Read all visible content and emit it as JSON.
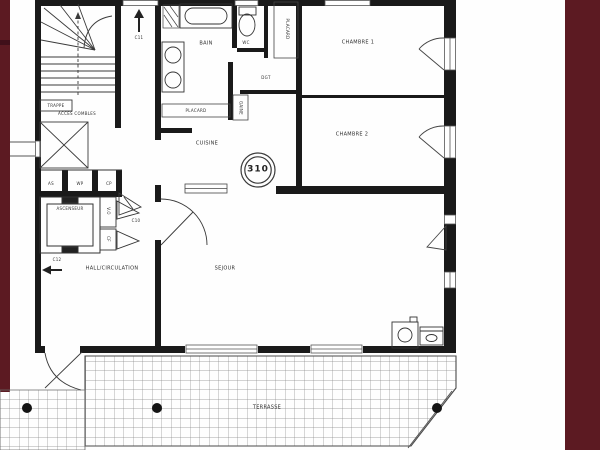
{
  "floorplan": {
    "unit_number": "310",
    "rooms": {
      "sejour": "SEJOUR",
      "cuisine": "CUISINE",
      "bain": "BAIN",
      "wc": "WC",
      "chambre1": "CHAMBRE 1",
      "chambre2": "CHAMBRE 2",
      "degagement": "DGT",
      "terrasse": "TERRASSE",
      "hall": "HALL/CIRCULATION",
      "ascenseur": "ASCENSEUR",
      "acces_combles": "ACCES COMBLES",
      "placard_entree": "PLACARD",
      "placard_cuisine": "PLACARD",
      "gaine": "GAINE",
      "trappe": "TRAPPE",
      "vide_ordures": "V.O",
      "gaine_cf": "CF"
    },
    "ducts": [
      "AS",
      "WP",
      "CP"
    ],
    "circulation_marks": {
      "up_arrow": "C11",
      "left_arrow": "C12",
      "entry_door": "C10"
    },
    "colors": {
      "side_band": "#5c1a22",
      "wall": "#1a1a1a",
      "paper": "#ffffff",
      "terrace_grid": "#8a8a8a"
    }
  }
}
